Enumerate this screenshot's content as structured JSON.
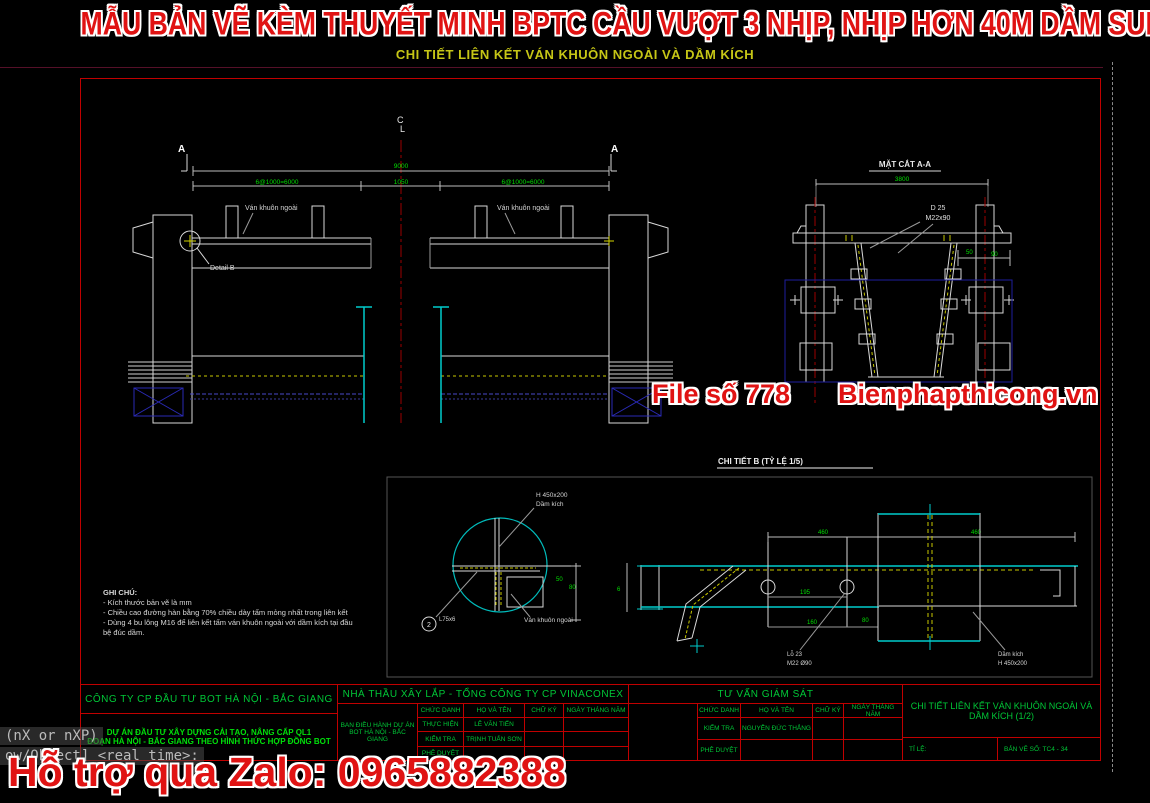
{
  "banner": {
    "title": "MẪU BẢN VẼ KÈM THUYẾT MINH BPTC CẦU VƯỢT 3 NHỊP, NHỊP HƠN 40M DẦM SUPER T",
    "subtitle": "CHI TIẾT LIÊN KẾT VÁN KHUÔN NGOÀI VÀ DẦM KÍCH"
  },
  "watermarks": {
    "file_no": "File số 778",
    "site": "Bienphapthicong.vn",
    "zalo": "Hỗ trợ qua Zalo: 0965882388",
    "color": "#e01313"
  },
  "console": {
    "line1": "(nX or nXP)",
    "line2": "ow/Object] <real time>:"
  },
  "elevation": {
    "centerline_c": "C",
    "centerline_l": "L",
    "section_mark_left": "A",
    "section_mark_right": "A",
    "dim_total": "9000",
    "dim_left": "6@1000=6000",
    "dim_center": "1050",
    "dim_right": "6@1000=6000",
    "label_formwork_left": "Ván khuôn ngoài",
    "label_formwork_right": "Ván khuôn ngoài",
    "label_detail": "Detail B"
  },
  "section_aa": {
    "title": "MẶT CẮT A-A",
    "dim_top": "3800",
    "label_d25": "D 25",
    "label_bolt": "M22x90",
    "dim_a": "50",
    "dim_b": "90"
  },
  "detail_b": {
    "title": "CHI TIẾT B (TỶ LỆ 1/5)",
    "label_beam_size": "H 450x200",
    "label_beam": "Dầm kích",
    "label_formwork": "Ván khuôn ngoài",
    "callout_number": "2",
    "callout_angle": "L75x6",
    "dim_a": "50",
    "dim_b": "80",
    "dim_c": "6"
  },
  "plan_detail": {
    "dim_top_left": "460",
    "dim_top_right": "460",
    "dim_mid": "195",
    "dim_low": "160",
    "dim_side": "80",
    "label_hole_1": "Lỗ 23",
    "label_hole_2": "M22 Ø90",
    "label_beam_1": "Dầm kích",
    "label_beam_2": "H 450x200"
  },
  "notes": {
    "title": "GHI CHÚ:",
    "line1": "- Kích thước bản vẽ là mm",
    "line2": "- Chiều cao đường hàn bằng 70% chiều dày tấm mỏng nhất trong liên kết",
    "line3": "- Dùng 4 bu lông M16 để liên kết tấm ván khuôn ngoài với dầm kích tại đầu",
    "line4": "bệ đúc dầm."
  },
  "titleblock": {
    "owner": {
      "company": "CÔNG TY CP ĐẦU TƯ BOT HÀ NỘI - BẮC GIANG",
      "project1": "DỰ ÁN ĐẦU TƯ XÂY DỰNG CẢI TẠO, NÂNG CẤP QL1",
      "project2": "ĐOẠN HÀ NỘI - BẮC GIANG THEO HÌNH THỨC HỢP ĐỒNG BOT"
    },
    "contractor": {
      "header": "NHÀ THẦU XÂY LẮP - TỔNG CÔNG TY CP VINACONEX",
      "board1": "BAN ĐIỀU HÀNH DỰ ÁN",
      "board2": "BOT HÀ NỘI - BẮC GIANG",
      "col1": "CHỨC DANH",
      "col2": "HỌ VÀ TÊN",
      "col3": "CHỮ KÝ",
      "col4": "NGÀY THÁNG NĂM",
      "r1c1": "THỰC HIỆN",
      "r1c2": "LÊ VĂN TIẾN",
      "r2c1": "KIỂM TRA",
      "r2c2": "TRỊNH TUẤN SƠN",
      "r3c1": "PHÊ DUYỆT",
      "r3c2": ""
    },
    "supervisor": {
      "header": "TƯ VẤN GIÁM SÁT",
      "col1": "CHỨC DANH",
      "col2": "HỌ VÀ TÊN",
      "col3": "CHỮ KÝ",
      "col4": "NGÀY THÁNG NĂM",
      "r1c1": "KIỂM TRA",
      "r1c2": "NGUYỄN ĐỨC THẮNG",
      "r2c1": "PHÊ DUYỆT",
      "r2c2": ""
    },
    "sheet": {
      "title1": "CHI TIẾT LIÊN KẾT VÁN KHUÔN NGOÀI VÀ",
      "title2": "DẦM KÍCH (1/2)",
      "scale_label": "TỈ LỆ:",
      "number_label": "BẢN VẼ SỐ:   TC4 - 34"
    }
  }
}
